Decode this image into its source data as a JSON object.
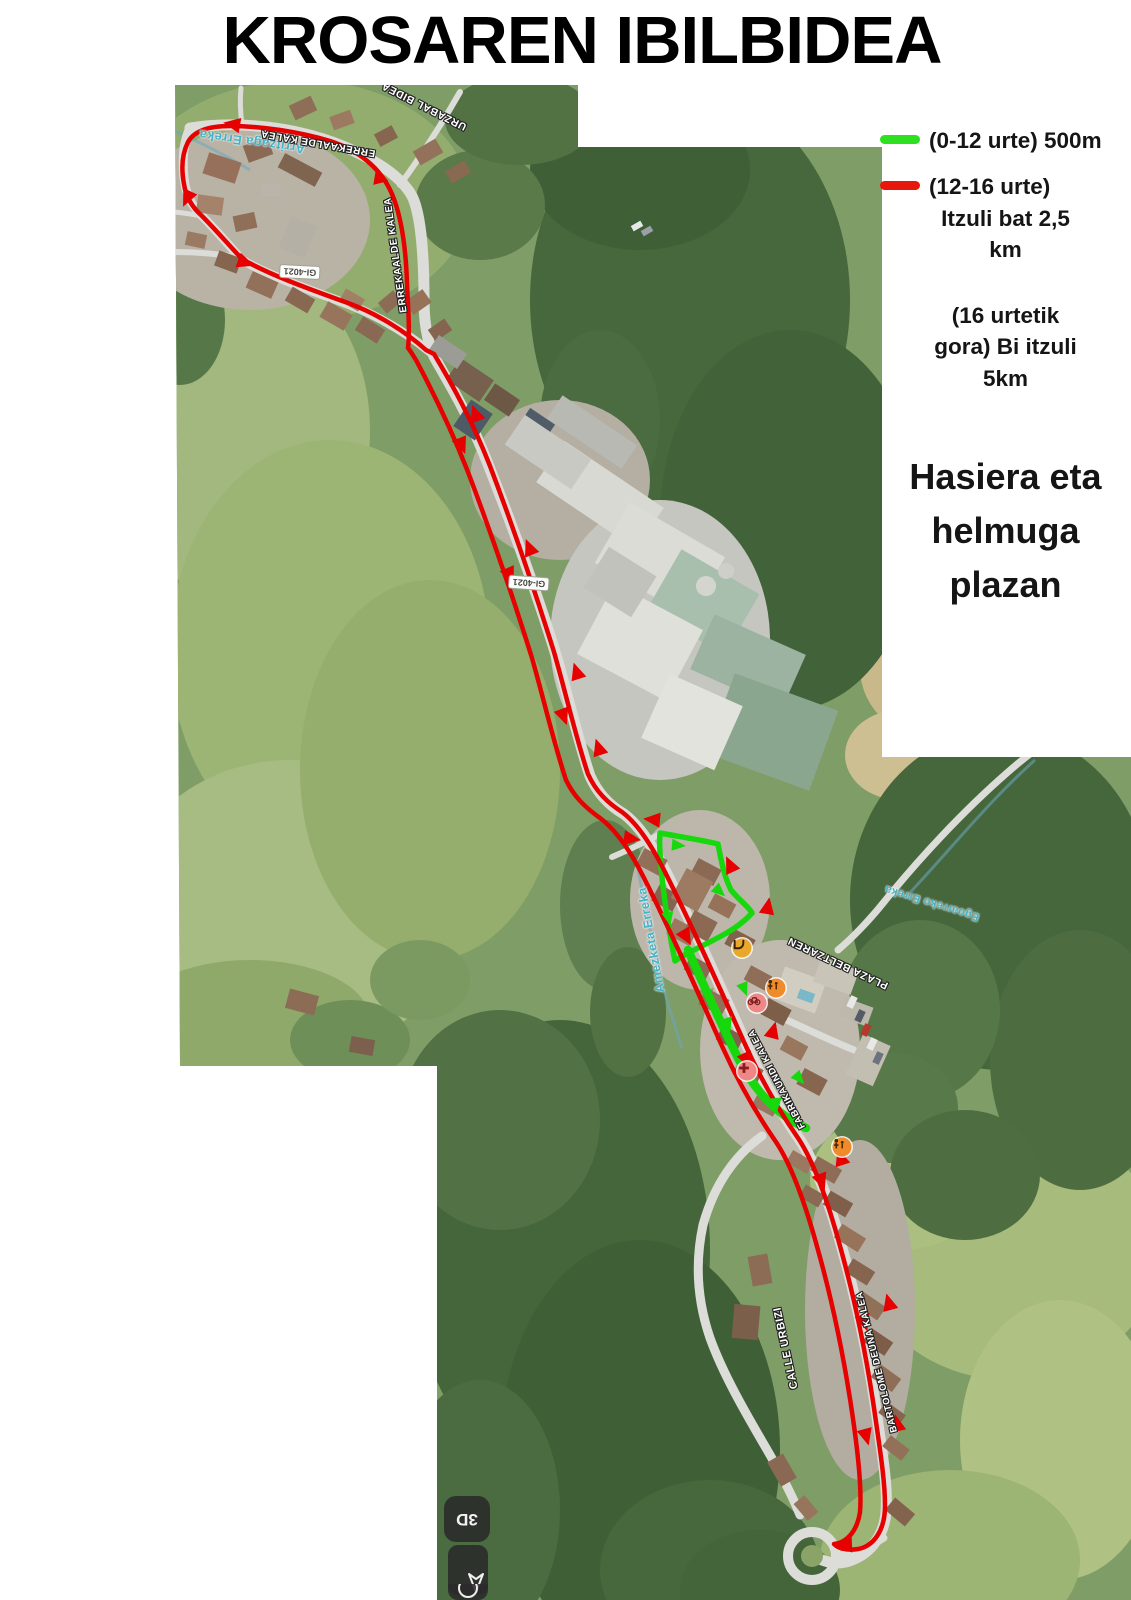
{
  "title": "KROSAREN IBILBIDEA",
  "legend": {
    "items": [
      {
        "id": "green",
        "swatch_color": "#2ee01f",
        "label": "(0-12 urte) 500m"
      },
      {
        "id": "red",
        "swatch_color": "#e8170b",
        "label": "(12-16 urte)",
        "sub_lines": [
          "Itzuli bat 2,5",
          "km"
        ]
      },
      {
        "id": "adult",
        "lines": [
          "(16 urtetik",
          "gora) Bi itzuli",
          "5km"
        ]
      }
    ],
    "note_lines": [
      "Hasiera eta",
      "helmuga",
      "plazan"
    ]
  },
  "map": {
    "road_shields": [
      {
        "text": "GI-4021",
        "x": 300,
        "y": 272,
        "rot": 183
      },
      {
        "text": "GI-4021",
        "x": 529,
        "y": 583,
        "rot": 184
      }
    ],
    "street_labels": [
      {
        "text": "Arritzaga Erreka",
        "x": 252,
        "y": 142,
        "rot": 188,
        "kind": "water",
        "size": 13
      },
      {
        "text": "ERREKAALDE KALEA",
        "x": 318,
        "y": 143,
        "rot": 190,
        "kind": "street",
        "size": 10
      },
      {
        "text": "ERREKAALDE KALEA",
        "x": 396,
        "y": 255,
        "rot": 262,
        "kind": "street",
        "size": 10
      },
      {
        "text": "URZABAL BIDEA",
        "x": 424,
        "y": 106,
        "rot": 207,
        "kind": "street",
        "size": 10.5
      },
      {
        "text": "Amezketa Erreka",
        "x": 651,
        "y": 940,
        "rot": 260,
        "kind": "water",
        "size": 12.5
      },
      {
        "text": "PLAZA BELTZAREN",
        "x": 838,
        "y": 963,
        "rot": 205,
        "kind": "street",
        "size": 10.5
      },
      {
        "text": "Egoarreko Erreka",
        "x": 932,
        "y": 903,
        "rot": 197,
        "kind": "water",
        "size": 11
      },
      {
        "text": "FABRIKAUNDI KALEA",
        "x": 777,
        "y": 1079,
        "rot": 242,
        "kind": "street",
        "size": 9.5
      },
      {
        "text": "CALLE URBIZI",
        "x": 786,
        "y": 1348,
        "rot": 258,
        "kind": "street",
        "size": 11
      },
      {
        "text": "BARTOLOME DEUNA KALEA",
        "x": 877,
        "y": 1362,
        "rot": 256,
        "kind": "street",
        "size": 9.5
      }
    ],
    "poi_markers": [
      {
        "icon": "slide-icon",
        "x": 742,
        "y": 948,
        "color": "#e9a72b"
      },
      {
        "icon": "playground-icon",
        "x": 776,
        "y": 988,
        "color": "#ef8b2a"
      },
      {
        "icon": "bicycle-icon",
        "x": 757,
        "y": 1003,
        "color": "#f08787"
      },
      {
        "icon": "pharmacy-icon",
        "x": 747,
        "y": 1071,
        "color": "#f08787"
      },
      {
        "icon": "playground-icon",
        "x": 842,
        "y": 1147,
        "color": "#ef8b2a"
      }
    ],
    "controls": {
      "button_3d_label": "3D"
    },
    "route_colors": {
      "kids": "#17d80d",
      "main": "#e60000"
    }
  }
}
